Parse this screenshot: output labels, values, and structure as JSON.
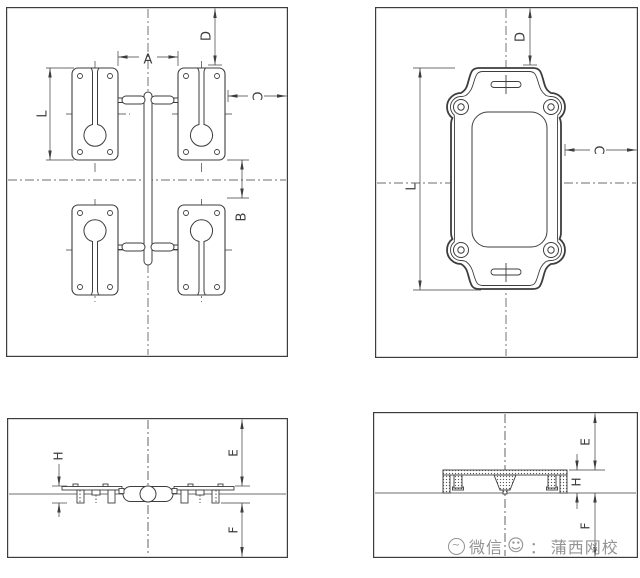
{
  "colors": {
    "line": "#3d3d3d",
    "background": "#ffffff",
    "watermark": "#8e8e8e"
  },
  "panels": {
    "mold_layout": {
      "dim_a": "A",
      "dim_b": "B",
      "dim_c": "C",
      "dim_d": "D",
      "dim_l": "L"
    },
    "part_top": {
      "dim_c": "C",
      "dim_d": "D",
      "dim_l": "L"
    },
    "mold_section": {
      "dim_e": "E",
      "dim_f": "F",
      "dim_h": "H"
    },
    "part_section": {
      "dim_e": "E",
      "dim_f": "F",
      "dim_h": "H"
    }
  },
  "watermark": {
    "app_name": "微信",
    "smiley": "☺",
    "separator": "：",
    "account_name": "蒲西网校"
  }
}
